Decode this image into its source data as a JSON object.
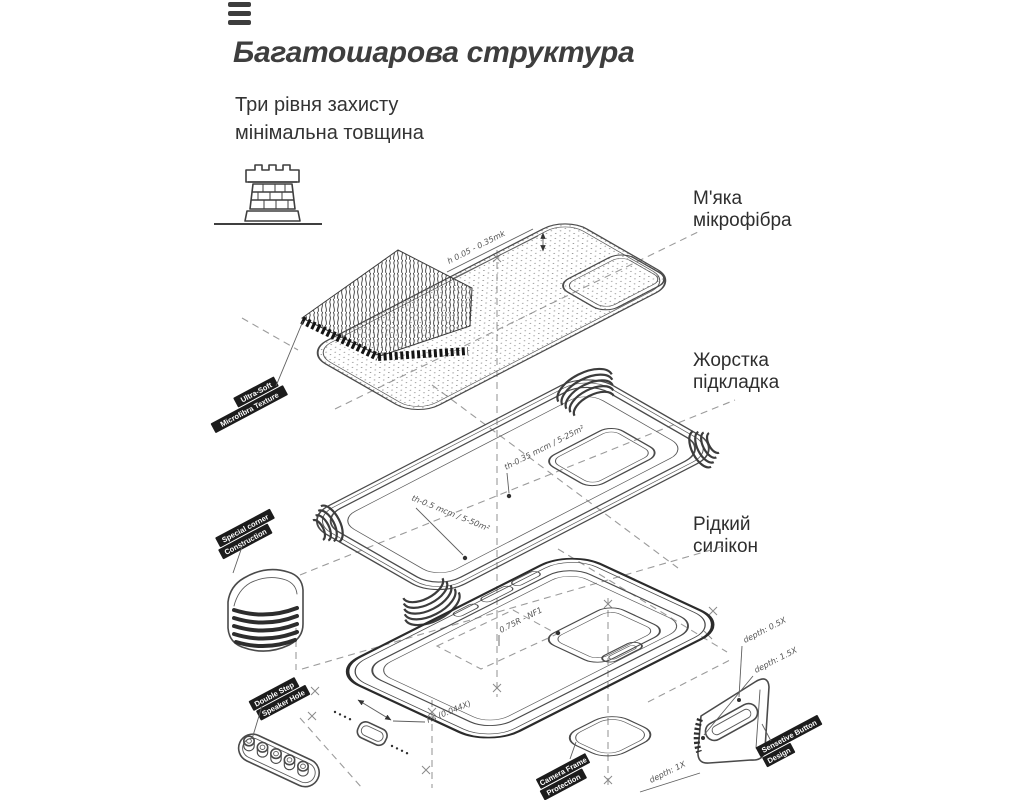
{
  "page": {
    "bg": "#ffffff",
    "ink": "#3e3e3e",
    "line": "#4a4a4a",
    "dash": "#9b9b9b",
    "label_bg": "#1c1c1c",
    "label_fg": "#ffffff"
  },
  "header": {
    "menu_icon": "hamburger-bars"
  },
  "heading": {
    "title": "Багатошарова структура",
    "subtitle": "Три рівня захисту\nмінімальна товщина"
  },
  "layer_labels": {
    "microfiber": "М'яка\nмікрофібра",
    "lining": "Жорстка\nпідкладка",
    "silicone": "Рідкий\nсилікон"
  },
  "callouts": {
    "ultra_soft": {
      "line1": "Ultra-Soft",
      "line2": "Microfibra Texture"
    },
    "special_corner": {
      "line1": "Special corner",
      "line2": "Construction"
    },
    "double_step": {
      "line1": "Double Step",
      "line2": "Speaker Hole"
    },
    "camera_frame": {
      "line1": "Camera Frame",
      "line2": "Protection"
    },
    "sensetive_button": {
      "line1": "Sensetive Button",
      "line2": "Design"
    }
  },
  "annotations": {
    "microfiber_height": "h 0.05 - 0.35mk",
    "lining_thickness_top": "th-0.35 mcm / 5-25m²",
    "lining_thickness_side": "th-0.5 mcm / 5-50m²",
    "case_radius_top": "0.75R - NF1",
    "case_radius_bottom": "Rs (0.044X)",
    "button_depth_1": "depth: 0.5X",
    "button_depth_2": "depth: 1.5X",
    "camera_depth": "depth: 1X"
  }
}
